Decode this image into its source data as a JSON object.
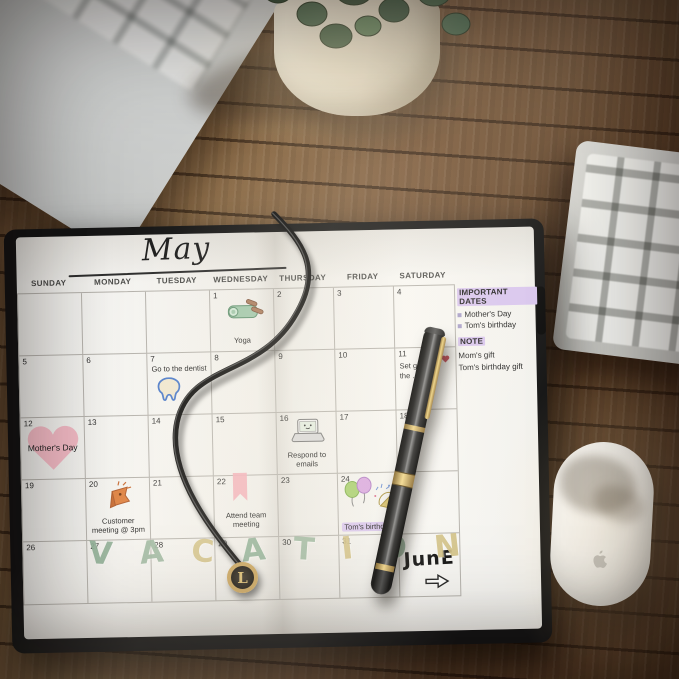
{
  "planner": {
    "month_title": "May",
    "day_headers": [
      "SUNDAY",
      "MONDAY",
      "TUESDAY",
      "WEDNESDAY",
      "THURSDAY",
      "FRIDAY",
      "SATURDAY"
    ],
    "weeks": [
      [
        {
          "date": ""
        },
        {
          "date": ""
        },
        {
          "date": ""
        },
        {
          "date": "1",
          "event": "Yoga",
          "sticker": "yoga-mat-sticker"
        },
        {
          "date": "2"
        },
        {
          "date": "3"
        },
        {
          "date": "4"
        }
      ],
      [
        {
          "date": "5"
        },
        {
          "date": "6"
        },
        {
          "date": "7",
          "event": "Go to the dentist",
          "sticker": "tooth-sticker"
        },
        {
          "date": "8"
        },
        {
          "date": "9"
        },
        {
          "date": "10"
        },
        {
          "date": "11",
          "event": "Set g…\nthe …",
          "sticker": "red-heart-mark"
        }
      ],
      [
        {
          "date": "12",
          "event": "Mother's Day",
          "sticker": "pink-heart-sticker"
        },
        {
          "date": "13"
        },
        {
          "date": "14"
        },
        {
          "date": "15"
        },
        {
          "date": "16",
          "event": "Respond to emails",
          "sticker": "laptop-sticker"
        },
        {
          "date": "17"
        },
        {
          "date": "18"
        }
      ],
      [
        {
          "date": "19"
        },
        {
          "date": "20",
          "event": "Customer meeting @ 3pm",
          "sticker": "orange-flag-sticker"
        },
        {
          "date": "21"
        },
        {
          "date": "22",
          "event": "Attend team meeting",
          "sticker": "pink-ribbon-sticker"
        },
        {
          "date": "23"
        },
        {
          "date": "24",
          "event": "Tom's birthday",
          "sticker": "balloons-sticker",
          "highlight": true
        },
        {
          "date": "25"
        }
      ],
      [
        {
          "date": "26"
        },
        {
          "date": "27"
        },
        {
          "date": "28"
        },
        {
          "date": "29"
        },
        {
          "date": "30"
        },
        {
          "date": "31"
        },
        {
          "date": "",
          "june_label": "JunE",
          "arrow": true
        }
      ]
    ],
    "vacation_letters": [
      {
        "ch": "V",
        "color": "#8fb096"
      },
      {
        "ch": "A",
        "color": "#9db8a0"
      },
      {
        "ch": "C",
        "color": "#d2c186"
      },
      {
        "ch": "A",
        "color": "#8fb096"
      },
      {
        "ch": "T",
        "color": "#9db8a0"
      },
      {
        "ch": "I",
        "color": "#d2c186"
      },
      {
        "ch": "O",
        "color": "#8fb096"
      },
      {
        "ch": "N",
        "color": "#d2c186"
      }
    ],
    "notes_panel": {
      "important_dates_title": "IMPORTANT DATES",
      "important_dates": [
        "Mother's Day",
        "Tom's birthday"
      ],
      "note_title": "NOTE",
      "notes": [
        "Mom's gift",
        "Tom's birthday gift"
      ]
    },
    "charm_letter": "L"
  },
  "colors": {
    "highlight_purple": "#d9c6ef",
    "vacation_green": "#8fb096",
    "vacation_tan": "#d2c186",
    "heart_pink": "#f3b7c3",
    "sticker_orange": "#e0813f"
  }
}
